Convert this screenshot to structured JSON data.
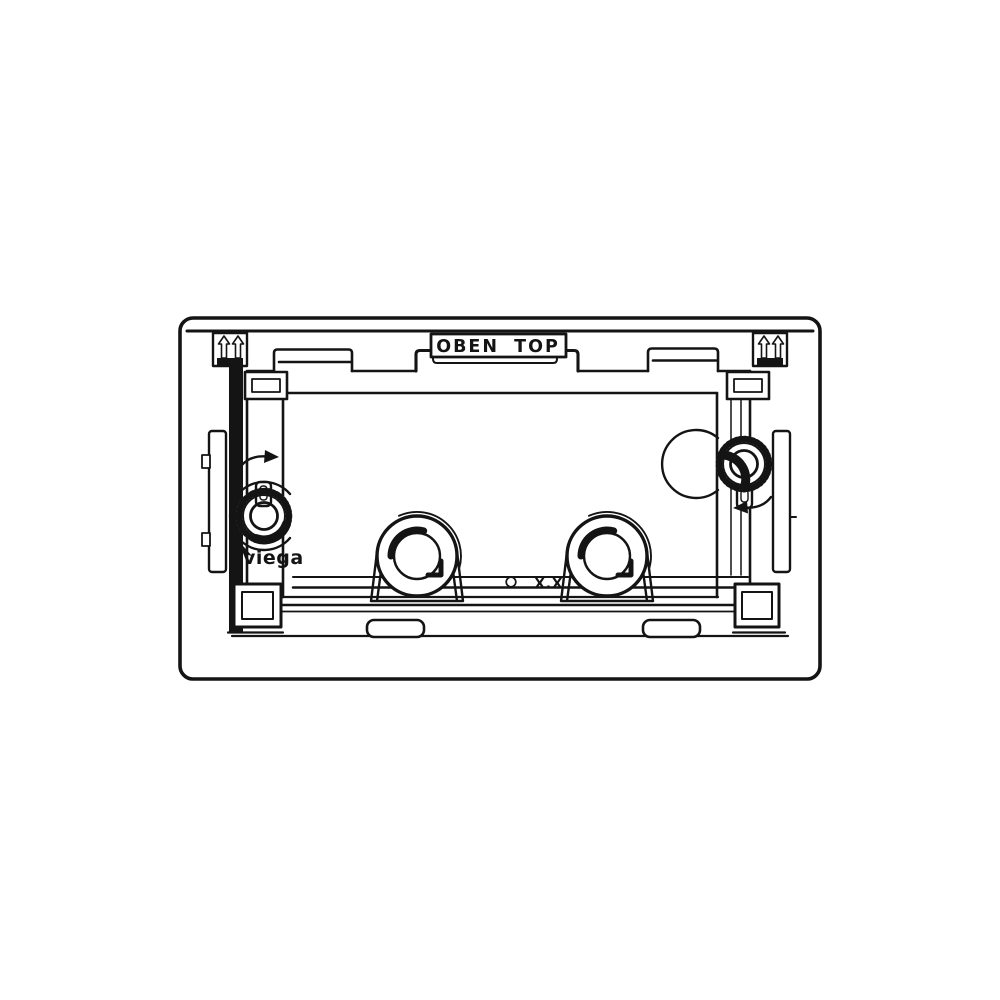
{
  "drawing": {
    "orientation_label": "OBEN TOP",
    "brand_label": "viega",
    "marking_label": "X.X",
    "colors": {
      "line": "#141414",
      "background": "#ffffff"
    },
    "icons": {
      "top_left": {
        "name": "double-up-arrow-icon",
        "glyph": "⇑⇑"
      },
      "top_right": {
        "name": "double-up-arrow-icon",
        "glyph": "⇑⇑"
      },
      "left_knob": {
        "name": "clockwise-rotation-arrow-icon",
        "glyph": "↷"
      },
      "right_knob": {
        "name": "counterclockwise-rotation-arrow-icon",
        "glyph": "↶"
      }
    }
  }
}
